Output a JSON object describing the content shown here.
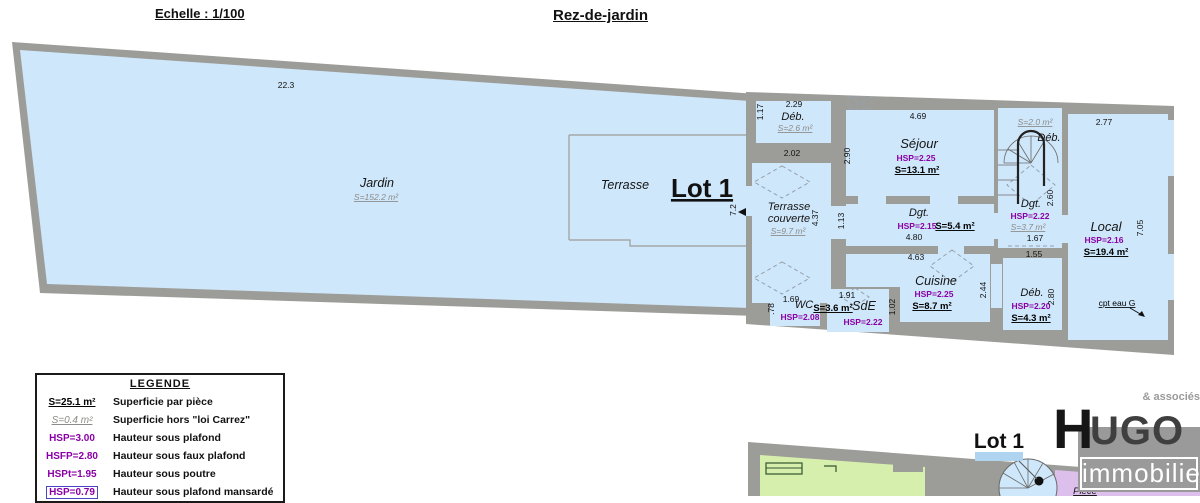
{
  "header": {
    "scale": "Echelle : 1/100",
    "title": "Rez-de-jardin"
  },
  "plan": {
    "lot_label": "Lot 1",
    "jardin": {
      "name": "Jardin",
      "area": "S=152.2 m²"
    },
    "terrasse": {
      "name": "Terrasse"
    },
    "terrasse_couverte": {
      "name_line1": "Terrasse",
      "name_line2": "couverte",
      "area": "S=9.7 m²"
    },
    "deb_top": {
      "name": "Déb.",
      "area": "S=2.6 m²"
    },
    "sejour": {
      "name": "Séjour",
      "hsp": "HSP=2.25",
      "area": "S=13.1 m²"
    },
    "dgt_center": {
      "name": "Dgt.",
      "hsp": "HSP=2.15",
      "area": "S=5.4 m²"
    },
    "dgt_right": {
      "name": "Dgt.",
      "hsp": "HSP=2.22",
      "area": "S=3.7 m²"
    },
    "deb_stairs": {
      "name": "Déb.",
      "area": "S=2.0 m²"
    },
    "local": {
      "name": "Local",
      "hsp": "HSP=2.16",
      "area": "S=19.4 m²"
    },
    "cuisine": {
      "name": "Cuisine",
      "hsp": "HSP=2.25",
      "area": "S=8.7 m²"
    },
    "wc": {
      "name": "WC",
      "hsp": "HSP=2.08",
      "area": "S=3.6 m²"
    },
    "sde": {
      "name": "SdE",
      "hsp": "HSP=2.22"
    },
    "deb_bottom": {
      "name": "Déb.",
      "hsp": "HSP=2.20",
      "area": "S=4.3 m²"
    },
    "cpt_eau": "cpt eau G",
    "dims": [
      "22.3",
      "7.2",
      "2.29",
      "1.17",
      "2.02",
      "2.90",
      "4.69",
      "2.77",
      "7.05",
      "4.37",
      "1.13",
      "2.60",
      "4.80",
      "1.67",
      "4.63",
      "1.55",
      "2.44",
      "1.69",
      ".78",
      "1.91",
      "1.02",
      "2.80"
    ]
  },
  "legend": {
    "title": "LEGENDE",
    "items": [
      {
        "key": "S=25.1 m²",
        "label": "Superficie par pièce"
      },
      {
        "key": "S=0.4 m²",
        "label": "Superficie hors \"loi Carrez\""
      },
      {
        "key": "HSP=3.00",
        "label": "Hauteur sous plafond"
      },
      {
        "key": "HSFP=2.80",
        "label": "Hauteur sous faux plafond"
      },
      {
        "key": "HSPt=1.95",
        "label": "Hauteur sous poutre"
      },
      {
        "key": "HSP=0.79",
        "label": "Hauteur sous plafond mansardé"
      }
    ]
  },
  "footer": {
    "lot_label": "Lot 1",
    "room": "Pièce"
  },
  "logo": {
    "assoc": "& associés",
    "initial": "H",
    "rest": "UGO",
    "tagline": "immobilier"
  },
  "colors": {
    "room_fill": "#cfe7fa",
    "wall": "#9c9c98",
    "hsp_text": "#8a00a6",
    "hors_carrez_text": "#8b8b89",
    "green_fill": "#d7efac",
    "purple_fill": "#ddbfec",
    "lot_highlight": "#aed4f0"
  }
}
